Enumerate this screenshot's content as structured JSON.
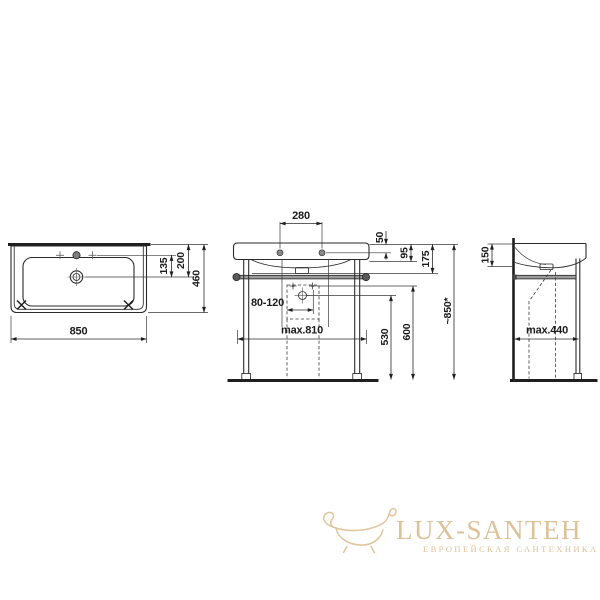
{
  "drawing_title": "washbasin-technical-drawing",
  "colors": {
    "line": "#2a2a2a",
    "brand_beige": "#dcc199",
    "rail_gray": "#9c9c9c"
  },
  "dims": {
    "top_width": "850",
    "top_depth": "460",
    "drain_from_rear": "200",
    "tap_to_drain": "135",
    "tap_spacing": "280",
    "edge_top": "50",
    "edge_front": "95",
    "edge_total": "175",
    "drain_range": "80-120",
    "max_width": "max.810",
    "trap_height": "530",
    "fixing_height": "600",
    "total_height": "~850*",
    "side_rim": "150",
    "side_depth": "max.440"
  },
  "watermark": {
    "brand": "LUX-SANTEH",
    "tagline": "ЕВРОПЕЙСКАЯ САНТЕХНИКА"
  }
}
